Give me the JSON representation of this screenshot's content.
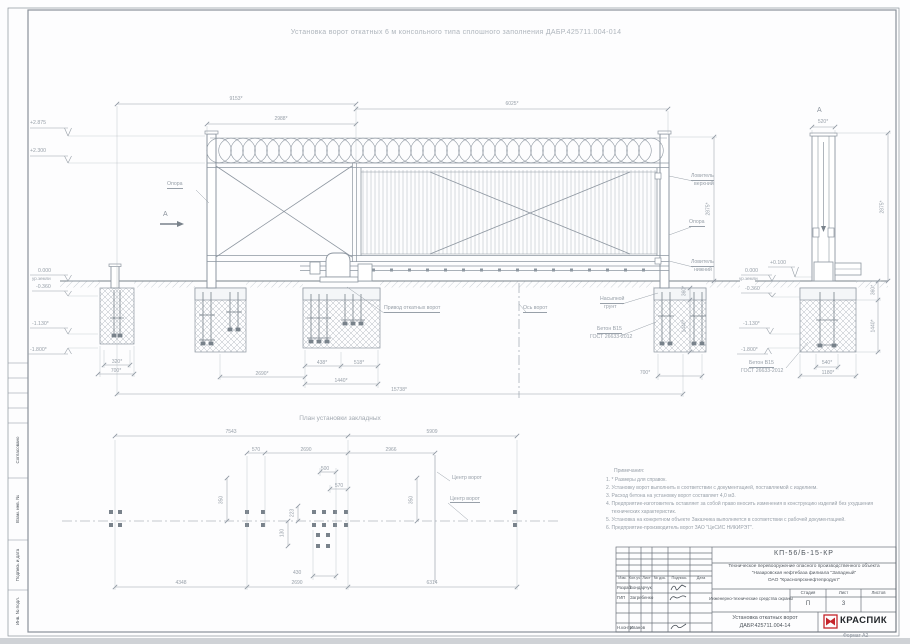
{
  "drawing_title": "Установка ворот откатных 6 м консольного типа сплошного заполнения ДАБР.425711.004-014",
  "margin_stamp": {
    "soglasovano": "Согласовано",
    "vzam_inv": "Взам. инв. №",
    "podpis_i_data": "Подпись и дата",
    "inv_podl": "Инв. № подл."
  },
  "elevation": {
    "section_mark_left": "А",
    "dims": {
      "overall_top": "9153*",
      "counterweight": "2988*",
      "leaf": "6025*",
      "height_right": "2875*",
      "f3_left": "438*",
      "f3_right": "518*",
      "f3_width": "1440*",
      "f2_to_f3": "2690*",
      "overall_bottom": "15738*",
      "f1_inner": "320*",
      "f1_width": "700*",
      "f4_width": "700*",
      "f4_depth_top": "360*",
      "f4_depth": "1440*"
    },
    "marks": {
      "top_coil": "+2.875",
      "top_rail": "+2.300",
      "ground": "0.000",
      "ground_note": "ур.земли",
      "minus_036": "-0.360",
      "minus_113": "-1.130*",
      "minus_180": "-1.800*"
    },
    "labels": {
      "opora_left": "Опора",
      "opora_right": "Опора",
      "lovitel_verh_line1": "Ловитель",
      "lovitel_verh_line2": "верхний",
      "lovitel_nizh_line1": "Ловитель",
      "lovitel_nizh_line2": "нижний",
      "privod": "Привод откатных ворот",
      "os_vorot": "Ось ворот",
      "nasypnoy_line1": "Насыпной",
      "nasypnoy_line2": "грунт",
      "beton_line1": "Бетон В15",
      "beton_line2": "ГОСТ 26633-2012"
    }
  },
  "section_a": {
    "mark": "А",
    "dims": {
      "width": "520*",
      "height": "2875*",
      "depth_top": "360*",
      "depth": "1440*",
      "base_inner": "540*",
      "base_width": "1180*"
    },
    "marks": {
      "ground": "0.000",
      "ground_note": "ур.земли",
      "plus_010": "+0.100",
      "minus_036": "-0.360",
      "minus_113": "-1.130*",
      "minus_180": "-1.800*"
    },
    "labels": {
      "beton_line1": "Бетон В15",
      "beton_line2": "ГОСТ 26633-2012"
    }
  },
  "plan": {
    "title": "План установки закладных",
    "dims": {
      "d7543": "7543",
      "d5909": "5909",
      "d570_left": "570",
      "d2690_top": "2690",
      "d2966": "2966",
      "d500": "500",
      "d570_mid": "570",
      "d350_right": "350",
      "d350_left": "350",
      "d223": "223",
      "d130": "130",
      "d430": "430",
      "d4348": "4348",
      "d2690_bottom": "2690",
      "d6314": "6314"
    },
    "labels": {
      "center_gate_1": "Центр ворот",
      "center_gate_2": "Центр ворот"
    }
  },
  "notes": {
    "title": "Примечания:",
    "lines": [
      "1. * Размеры для справок.",
      "2. Установку ворот выполнить в соответствии с документацией, поставляемой с изделием.",
      "3. Расход бетона на установку ворот составляет 4,0 м3.",
      "4. Предприятие-изготовитель оставляет за собой право вносить изменения в конструкцию изделий без ухудшения",
      "    технических характеристик.",
      "5. Установка на конкретном объекте Заказчика выполняется в соответствии с рабочей документацией.",
      "6. Предприятие-производитель ворот ЗАО \"ЦеСИС НИКИРЭТ\"."
    ]
  },
  "title_block": {
    "doc_number": "КП-56/Б-15-КР",
    "project_line1": "Техническое перевооружение опасного производственного объекта",
    "project_line2": "\"Назаровская нефтебаза филиала \"Западный\"",
    "project_line3": "ОАО \"Красноярскнефтепродукт\"",
    "columns": {
      "izm": "Изм.",
      "kol_uch": "Кол.уч.",
      "list": "Лист",
      "n_dok": "№ док.",
      "podpis": "Подпись",
      "data": "Дата"
    },
    "rows": {
      "razrab_label": "Разраб.",
      "razrab_name": "Бондарчук",
      "gip_label": "ГИП",
      "gip_name": "Загребенко",
      "nkontr_label": "Н.контр.",
      "nkontr_name": "Иванов"
    },
    "subject": "Инженерно-технические средства охраны",
    "stage": {
      "label": "Стадия",
      "value": "П"
    },
    "sheet": {
      "label": "Лист",
      "value": "3"
    },
    "sheets": {
      "label": "Листов",
      "value": ""
    },
    "name_line1": "Установка откатных ворот",
    "name_line2": "ДАБР.425711.004-14",
    "logo_text": "КРАСПИК",
    "format_label": "Формат А2"
  }
}
